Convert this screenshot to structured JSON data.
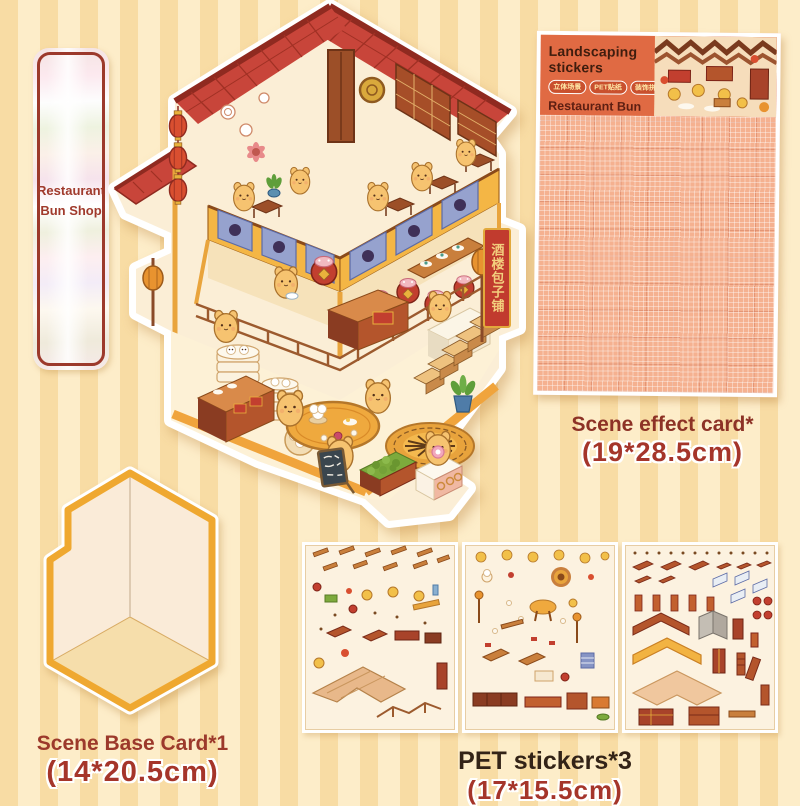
{
  "bookmark": {
    "title_line1": "Restaurant",
    "title_line2": "Bun Shop"
  },
  "package": {
    "title": "Landscaping stickers",
    "badges": [
      {
        "label": "立体场景"
      },
      {
        "label": "PET贴纸"
      },
      {
        "label": "装饰拼贴"
      }
    ],
    "subtitle": "Restaurant Bun Shop"
  },
  "scene": {
    "banner_text": "酒楼包子铺"
  },
  "labels": {
    "scene_effect_title": "Scene effect card*",
    "scene_effect_size": "(19*28.5cm)",
    "base_card_title": "Scene Base Card*1",
    "base_card_size": "(14*20.5cm)",
    "pet_title": "PET stickers*3",
    "pet_size": "(17*15.5cm)"
  },
  "colors": {
    "background_stripe_light": "#fdedc9",
    "background_stripe_dark": "#f8dca4",
    "accent_red": "#c13b2e",
    "roof_red": "#c8453a",
    "balcony_yellow": "#f4b645",
    "panel_blue": "#96a2ce",
    "character_yellow": "#f6c370",
    "package_orange": "#e06a43",
    "grid_paper": "#f5b190",
    "label_dark_red": "#8d3226",
    "floor_border_orange": "#f0a43c"
  }
}
